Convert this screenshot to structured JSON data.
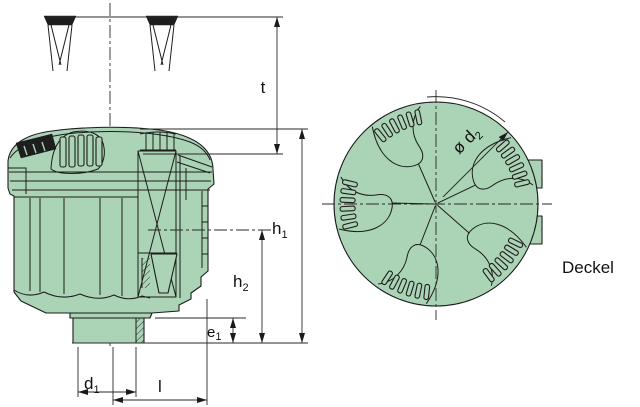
{
  "drawing": {
    "background": "#ffffff",
    "part_fill": "#abd3b5",
    "line_color": "#1c1c1c",
    "dim_color": "#2a2a2a"
  },
  "labels": {
    "t": "t",
    "h1": {
      "main": "h",
      "sub": "1"
    },
    "h2": {
      "main": "h",
      "sub": "2"
    },
    "e1": {
      "main": "e",
      "sub": "1"
    },
    "d1": {
      "main": "d",
      "sub": "1"
    },
    "l": "l",
    "d2": {
      "main": "ø d",
      "sub": "2"
    },
    "cover": "Deckel"
  }
}
